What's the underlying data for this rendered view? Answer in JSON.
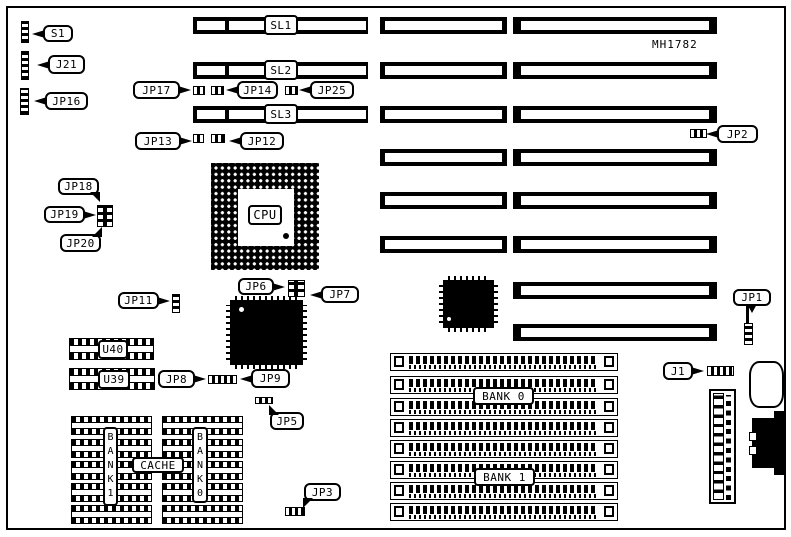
{
  "board_id": "MH1782",
  "colors": {
    "ink": "#000000",
    "paper": "#ffffff"
  },
  "callouts": {
    "s1": "S1",
    "j21": "J21",
    "jp16": "JP16",
    "jp17": "JP17",
    "jp14": "JP14",
    "jp25": "JP25",
    "jp13": "JP13",
    "jp12": "JP12",
    "jp2": "JP2",
    "jp18": "JP18",
    "jp19": "JP19",
    "jp20": "JP20",
    "jp11": "JP11",
    "jp6": "JP6",
    "jp7": "JP7",
    "jp8": "JP8",
    "jp9": "JP9",
    "jp5": "JP5",
    "jp3": "JP3",
    "jp1": "JP1",
    "j1": "J1"
  },
  "slot_labels": {
    "sl1": "SL1",
    "sl2": "SL2",
    "sl3": "SL3"
  },
  "component_labels": {
    "cpu": "CPU",
    "u40": "U40",
    "u39": "U39",
    "cache": "CACHE"
  },
  "memory_labels": {
    "cache_bank1": "BANK1",
    "cache_bank0": "BANK0",
    "simm_bank0": "BANK 0",
    "simm_bank1": "BANK 1"
  }
}
